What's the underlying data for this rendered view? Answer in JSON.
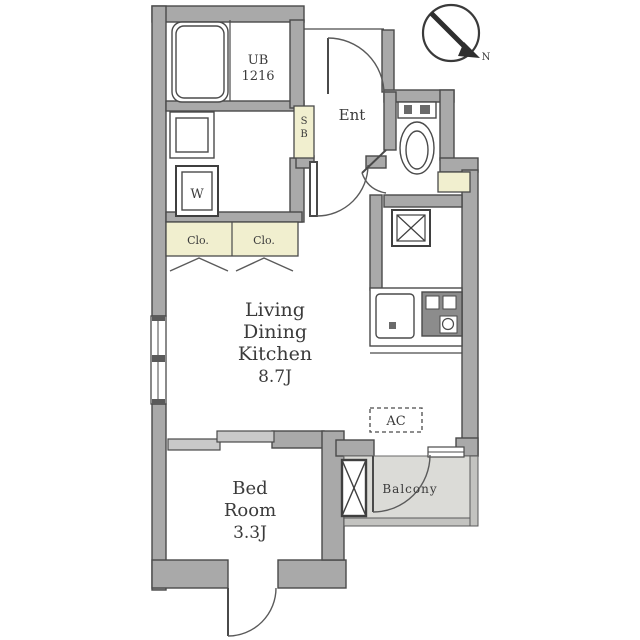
{
  "plan": {
    "title": "apartment-floor-plan",
    "compass": {
      "north_label": "N"
    },
    "rooms": {
      "living_dining_kitchen": {
        "name_lines": [
          "Living",
          "Dining",
          "Kitchen"
        ],
        "size": "8.7J"
      },
      "bedroom": {
        "name_lines": [
          "Bed",
          "Room"
        ],
        "size": "3.3J"
      },
      "unit_bath": {
        "label": "UB",
        "size_code": "1216"
      },
      "entrance": {
        "label": "Ent"
      },
      "balcony": {
        "label": "Balcony"
      }
    },
    "fixtures": {
      "shoe_box": {
        "letters": [
          "S",
          "B"
        ]
      },
      "washer": {
        "label": "W"
      },
      "closet_left": {
        "label": "Clo."
      },
      "closet_right": {
        "label": "Clo."
      },
      "air_conditioner": {
        "label": "AC"
      }
    },
    "colors": {
      "wall_gray": "#a9a9a9",
      "closet_cream": "#f1efcf",
      "balcony_gray": "#dbdbd7",
      "line_dark": "#4a4a4a",
      "text": "#3b3b3b"
    }
  }
}
